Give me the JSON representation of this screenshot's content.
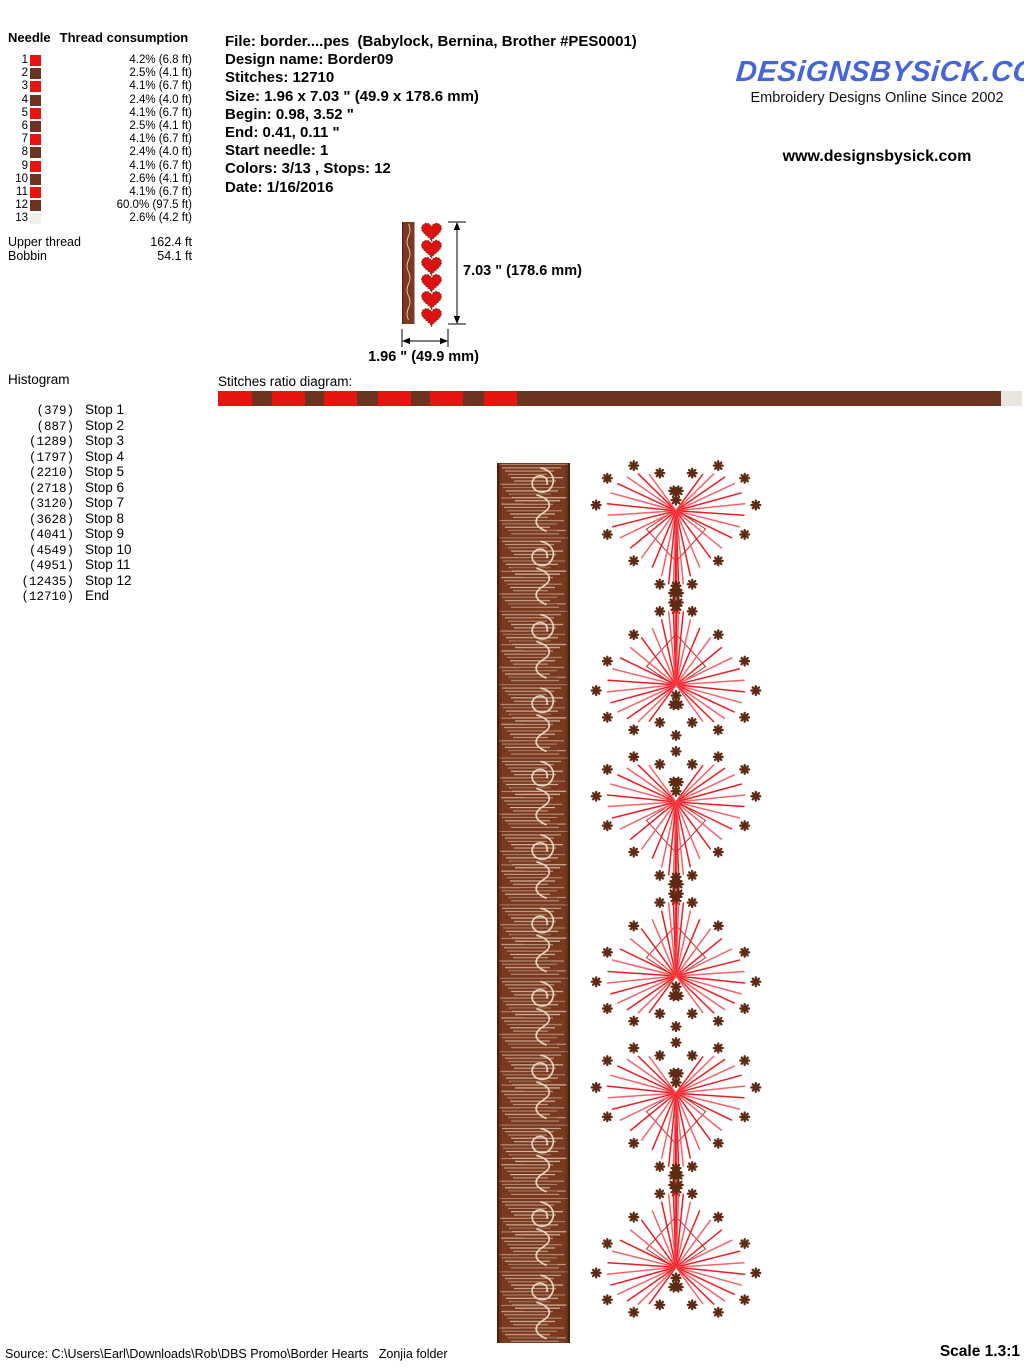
{
  "header": {
    "needle_table": {
      "col_needle": "Needle",
      "col_thread": "Thread consumption",
      "rows": [
        {
          "needle": "1",
          "color": "#e8140f",
          "consumption": "4.2% (6.8 ft)"
        },
        {
          "needle": "2",
          "color": "#6b3320",
          "consumption": "2.5% (4.1 ft)"
        },
        {
          "needle": "3",
          "color": "#e8140f",
          "consumption": "4.1% (6.7 ft)"
        },
        {
          "needle": "4",
          "color": "#6b3320",
          "consumption": "2.4% (4.0 ft)"
        },
        {
          "needle": "5",
          "color": "#e8140f",
          "consumption": "4.1% (6.7 ft)"
        },
        {
          "needle": "6",
          "color": "#6b3320",
          "consumption": "2.5% (4.1 ft)"
        },
        {
          "needle": "7",
          "color": "#e8140f",
          "consumption": "4.1% (6.7 ft)"
        },
        {
          "needle": "8",
          "color": "#6b3320",
          "consumption": "2.4% (4.0 ft)"
        },
        {
          "needle": "9",
          "color": "#e8140f",
          "consumption": "4.1% (6.7 ft)"
        },
        {
          "needle": "10",
          "color": "#6b3320",
          "consumption": "2.6% (4.1 ft)"
        },
        {
          "needle": "11",
          "color": "#e8140f",
          "consumption": "4.1% (6.7 ft)"
        },
        {
          "needle": "12",
          "color": "#6b3320",
          "consumption": "60.0% (97.5 ft)"
        },
        {
          "needle": "13",
          "color": "#f1efeb",
          "consumption": "2.6% (4.2 ft)"
        }
      ],
      "totals": [
        {
          "label": "Upper thread",
          "value": "162.4 ft"
        },
        {
          "label": "Bobbin",
          "value": "54.1 ft"
        }
      ]
    },
    "file_info": {
      "lines": [
        "File: border....pes  (Babylock, Bernina, Brother #PES0001)",
        "Design name: Border09",
        "Stitches: 12710",
        "Size: 1.96 x 7.03 \" (49.9 x 178.6 mm)",
        "Begin: 0.98, 3.52 \"",
        "End: 0.41, 0.11 \"",
        "Start needle: 1",
        "Colors: 3/13 , Stops: 12",
        "Date: 1/16/2016"
      ]
    },
    "brand": {
      "logo": "DESiGNSBYSiCK.COM",
      "logo_color": "#4565d8",
      "tagline": "Embroidery Designs Online Since 2002",
      "url": "www.designsbysick.com"
    }
  },
  "thumbnail": {
    "dim_height": "7.03 \" (178.6 mm)",
    "dim_width": "1.96 \" (49.9 mm)"
  },
  "histogram": {
    "title": "Histogram",
    "rows": [
      {
        "count": "(379)",
        "label": "Stop 1"
      },
      {
        "count": "(887)",
        "label": "Stop 2"
      },
      {
        "count": "(1289)",
        "label": "Stop 3"
      },
      {
        "count": "(1797)",
        "label": "Stop 4"
      },
      {
        "count": "(2210)",
        "label": "Stop 5"
      },
      {
        "count": "(2718)",
        "label": "Stop 6"
      },
      {
        "count": "(3120)",
        "label": "Stop 7"
      },
      {
        "count": "(3628)",
        "label": "Stop 8"
      },
      {
        "count": "(4041)",
        "label": "Stop 9"
      },
      {
        "count": "(4549)",
        "label": "Stop 10"
      },
      {
        "count": "(4951)",
        "label": "Stop 11"
      },
      {
        "count": "(12435)",
        "label": "Stop 12"
      },
      {
        "count": "(12710)",
        "label": "End"
      }
    ]
  },
  "stitches_ratio": {
    "title": "Stitches ratio diagram:",
    "segments": [
      {
        "pct": 4.2,
        "color": "#e8140f"
      },
      {
        "pct": 2.5,
        "color": "#6b3320"
      },
      {
        "pct": 4.1,
        "color": "#e8140f"
      },
      {
        "pct": 2.4,
        "color": "#6b3320"
      },
      {
        "pct": 4.1,
        "color": "#e8140f"
      },
      {
        "pct": 2.5,
        "color": "#6b3320"
      },
      {
        "pct": 4.1,
        "color": "#e8140f"
      },
      {
        "pct": 2.4,
        "color": "#6b3320"
      },
      {
        "pct": 4.1,
        "color": "#e8140f"
      },
      {
        "pct": 2.6,
        "color": "#6b3320"
      },
      {
        "pct": 4.1,
        "color": "#e8140f"
      },
      {
        "pct": 60.0,
        "color": "#6b3320"
      },
      {
        "pct": 2.6,
        "color": "#e9e6df"
      }
    ]
  },
  "design": {
    "strip": {
      "x": 497,
      "y": 463,
      "w": 73,
      "h": 880,
      "base": "#7a3a1f",
      "edge": "#4c1d09",
      "motif": "#ecdcc8",
      "texture": "#f3e4d2"
    },
    "hearts": {
      "cx": 676,
      "cy0": 525,
      "pitch": 145.6,
      "count": 6,
      "scale": 4.3,
      "line_color": "#ee1016",
      "line_color2": "#f85a60",
      "dot_color": "#5e2a13",
      "inner_color": "#a81414"
    },
    "thumb": {
      "strip_x": 402,
      "strip_y": 222,
      "strip_w": 12.5,
      "strip_h": 102,
      "heart_cx": 431.5,
      "heart_cy0": 230.7,
      "heart_pitch": 17.05,
      "heart_scale": 0.62,
      "heart_fill": "#dd1111",
      "heart_stroke": "#6b2f1f"
    }
  },
  "footer": {
    "source": "Source: C:\\Users\\Earl\\Downloads\\Rob\\DBS Promo\\Border Hearts   Zonjia folder",
    "scale": "Scale 1.3:1"
  }
}
